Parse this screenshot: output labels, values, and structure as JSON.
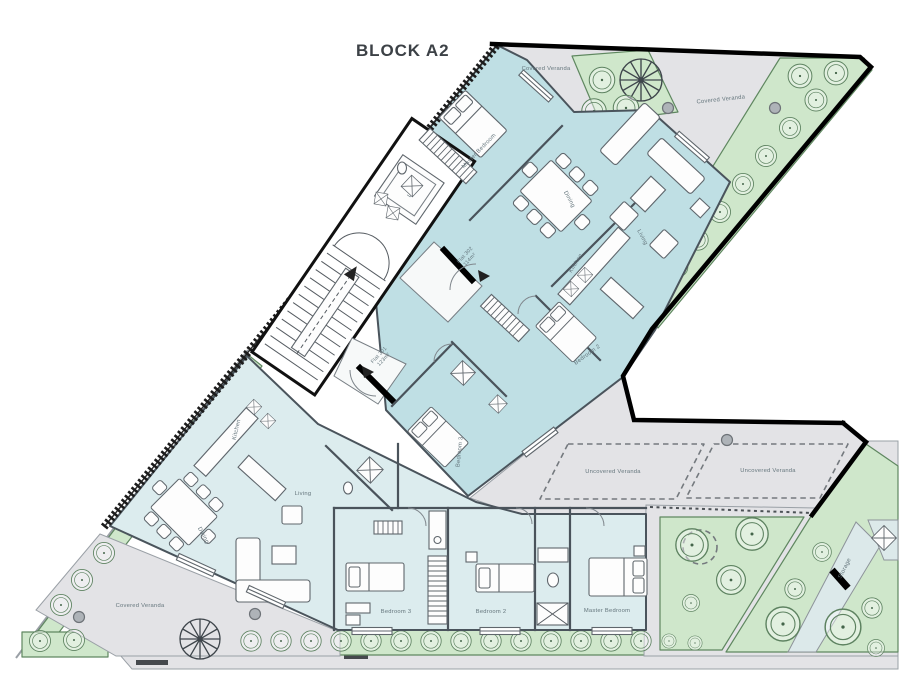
{
  "title": "BLOCK A2",
  "colors": {
    "flat_upper_fill": "#bfdfe4",
    "flat_lower_fill": "#dcecee",
    "veranda_fill": "#e3e3e6",
    "green_fill": "#cfe7cb",
    "green_stroke": "#5f8760",
    "boundary_black": "#000000",
    "label_color": "#64757c",
    "title_color": "#3c4146"
  },
  "labels": {
    "covered_veranda": "Covered Veranda",
    "uncovered_veranda": "Uncovered Veranda",
    "storage": "Storage",
    "lift": "LIFT",
    "flat302": {
      "name": "Flat 302",
      "area": "114m²"
    },
    "flat301": {
      "name": "Flat 301",
      "area": "123m²"
    },
    "rooms": {
      "master_bedroom": "Master Bedroom",
      "bedroom2": "Bedroom 2",
      "bedroom3": "Bedroom 3",
      "kitchen": "Kitchen",
      "dining": "Dining",
      "living": "Living"
    }
  }
}
